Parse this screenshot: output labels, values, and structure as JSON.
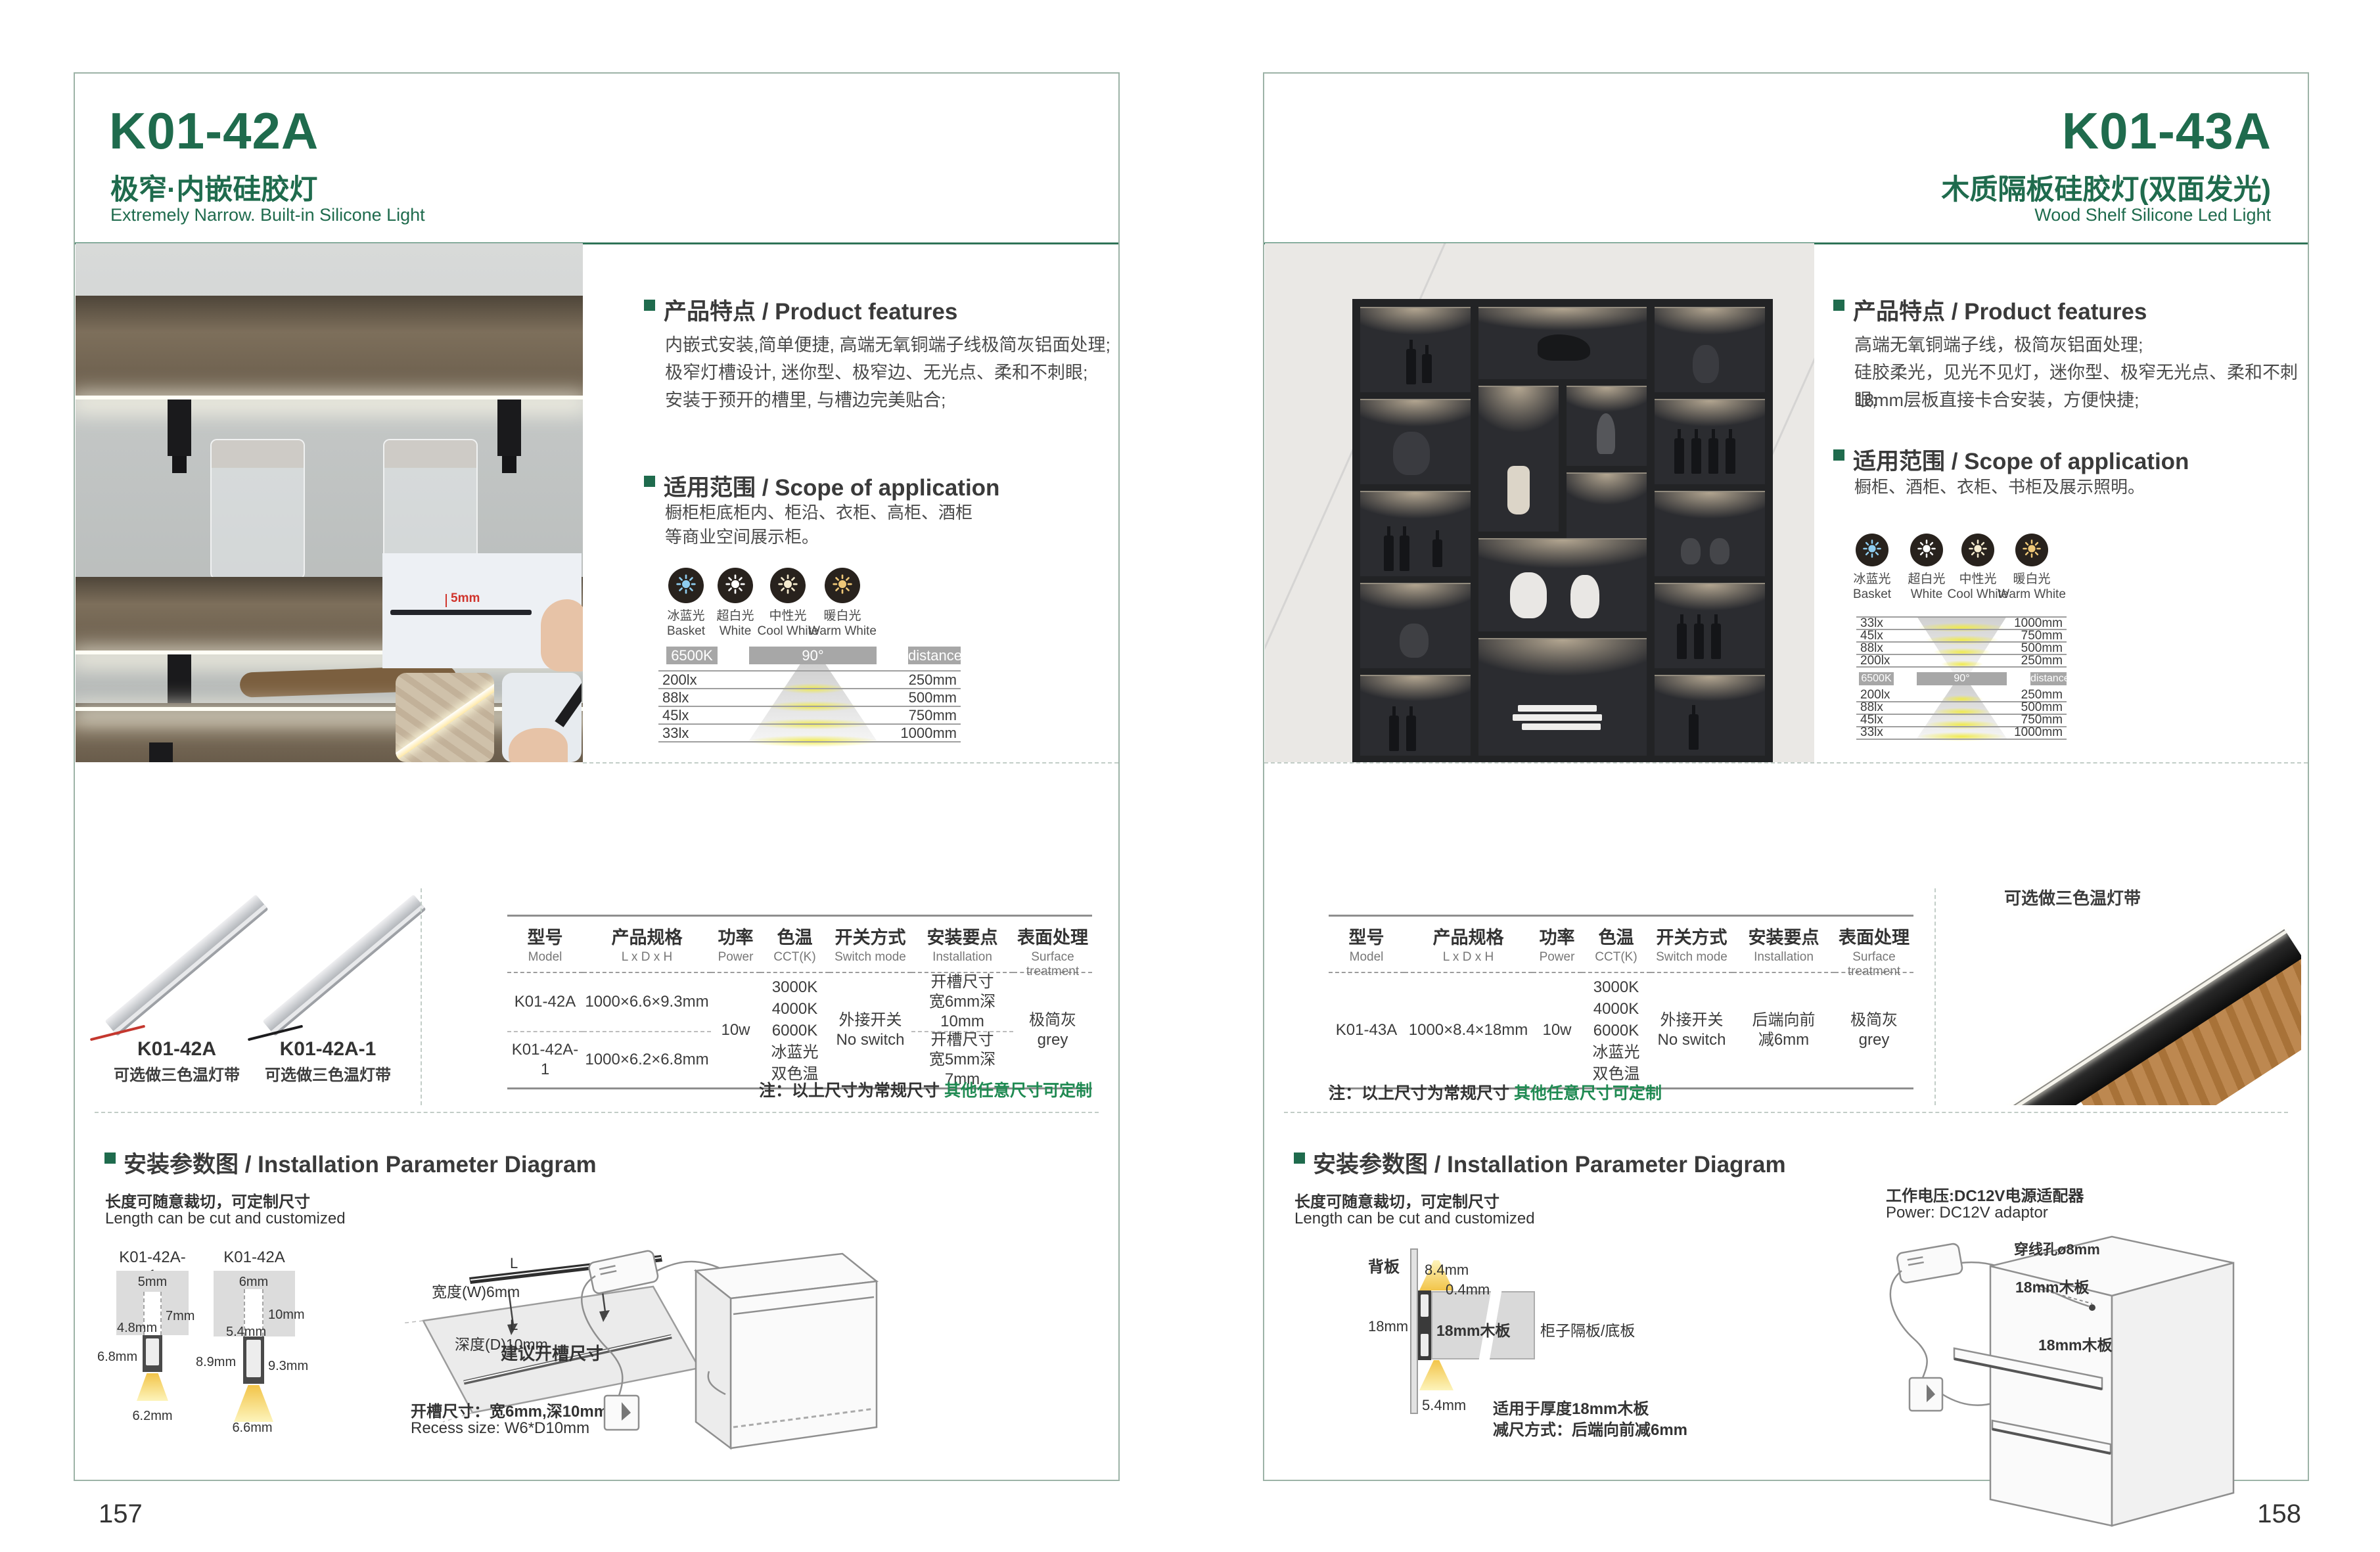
{
  "colors": {
    "green": "#1f6b4d",
    "note_green": "#1f8a52",
    "ice": "#8ecdf0",
    "white": "#ffffff",
    "neutral": "#f6ecd0",
    "warm": "#efc878",
    "bar_gray": "#a7a7a7"
  },
  "shared": {
    "features_title": "产品特点 / Product features",
    "scope_title": "适用范围 / Scope of application",
    "install_title": "安装参数图 / Installation Parameter Diagram",
    "cut_zh": "长度可随意裁切，可定制尺寸",
    "cut_en": "Length can be cut and customized",
    "note_black": "注：以上尺寸为常规尺寸 ",
    "note_green": "其他任意尺寸可定制",
    "chart": {
      "cct": "6500K",
      "angle": "90°",
      "dist": "distance"
    },
    "cct_icons": [
      {
        "zh": "冰蓝光",
        "en": "Basket"
      },
      {
        "zh": "超白光",
        "en": "White"
      },
      {
        "zh": "中性光",
        "en": "Cool White"
      },
      {
        "zh": "暖白光",
        "en": "Warm White"
      }
    ],
    "headers": [
      {
        "zh": "型号",
        "en": "Model"
      },
      {
        "zh": "产品规格",
        "en": "L x D x H"
      },
      {
        "zh": "功率",
        "en": "Power"
      },
      {
        "zh": "色温",
        "en": "CCT(K)"
      },
      {
        "zh": "开关方式",
        "en": "Switch mode"
      },
      {
        "zh": "安装要点",
        "en": "Installation"
      },
      {
        "zh": "表面处理",
        "en": "Surface treatment"
      }
    ]
  },
  "left": {
    "page_number": "157",
    "model": "K01-42A",
    "subtitle_zh": "极窄·内嵌硅胶灯",
    "subtitle_en": "Extremely Narrow. Built-in Silicone Light",
    "features": [
      "内嵌式安装,简单便捷, 高端无氧铜端子线极简灰铝面处理;",
      "极窄灯槽设计, 迷你型、极窄边、无光点、柔和不刺眼;",
      "安装于预开的槽里, 与槽边完美贴合;"
    ],
    "scope": "橱柜柜底柜内、柜沿、衣柜、高柜、酒柜\n等商业空间展示柜。",
    "inset_dim": "5mm",
    "chart_rows": [
      {
        "lux": "200lx",
        "mm": "250mm"
      },
      {
        "lux": "88lx",
        "mm": "500mm"
      },
      {
        "lux": "45lx",
        "mm": "750mm"
      },
      {
        "lux": "33lx",
        "mm": "1000mm"
      }
    ],
    "product1_name": "K01-42A",
    "product1_caption": "可选做三色温灯带",
    "product2_name": "K01-42A-1",
    "product2_caption": "可选做三色温灯带",
    "table": {
      "r1": {
        "model": "K01-42A",
        "size": "1000×6.6×9.3mm",
        "install": "开槽尺寸\n宽6mm深10mm"
      },
      "r2": {
        "model": "K01-42A-1",
        "size": "1000×6.2×6.8mm",
        "install": "开槽尺寸\n宽5mm深7mm"
      },
      "power": "10w",
      "cct": "3000K\n4000K\n6000K\n冰蓝光\n双色温",
      "switch": "外接开关\nNo switch",
      "surface": "极简灰\ngrey"
    },
    "diag1": {
      "label": "K01-42A-1",
      "top": "5mm",
      "depth": "7mm",
      "inner": "4.8mm",
      "height": "6.8mm",
      "bottom": "6.2mm"
    },
    "diag2": {
      "label": "K01-42A",
      "top": "6mm",
      "depth": "10mm",
      "inner": "5.4mm",
      "left": "8.9mm",
      "right": "9.3mm",
      "bottom": "6.6mm"
    },
    "board": {
      "w": "宽度(W)6mm",
      "d": "深度(D)10mm",
      "l1": "L",
      "l2": "L",
      "caption": "建议开槽尺寸"
    },
    "recess_zh": "开槽尺寸：宽6mm,深10mm",
    "recess_en": "Recess size: W6*D10mm"
  },
  "right": {
    "page_number": "158",
    "model": "K01-43A",
    "subtitle_zh": "木质隔板硅胶灯(双面发光)",
    "subtitle_en": "Wood Shelf Silicone Led Light",
    "features": [
      "高端无氧铜端子线，极简灰铝面处理;",
      "硅胶柔光，见光不见灯，迷你型、极窄无光点、柔和不刺眼;",
      "18mm层板直接卡合安装，方便快捷;"
    ],
    "scope": "橱柜、酒柜、衣柜、书柜及展示照明。",
    "chart_rows_top": [
      {
        "lux": "33lx",
        "mm": "1000mm"
      },
      {
        "lux": "45lx",
        "mm": "750mm"
      },
      {
        "lux": "88lx",
        "mm": "500mm"
      },
      {
        "lux": "200lx",
        "mm": "250mm"
      }
    ],
    "chart_rows_bottom": [
      {
        "lux": "200lx",
        "mm": "250mm"
      },
      {
        "lux": "88lx",
        "mm": "500mm"
      },
      {
        "lux": "45lx",
        "mm": "750mm"
      },
      {
        "lux": "33lx",
        "mm": "1000mm"
      }
    ],
    "product_caption": "可选做三色温灯带",
    "table": {
      "model": "K01-43A",
      "size": "1000×8.4×18mm",
      "power": "10w",
      "cct": "3000K\n4000K\n6000K\n冰蓝光\n双色温",
      "switch": "外接开关\nNo switch",
      "install": "后端向前\n减6mm",
      "surface": "极简灰\ngrey"
    },
    "cs": {
      "back": "背板",
      "d84": "8.4mm",
      "d04": "0.4mm",
      "d18": "18mm",
      "board": "18mm木板",
      "shelf": "柜子隔板/底板",
      "d54": "5.4mm",
      "fit1": "适用于厚度18mm木板",
      "fit2": "减尺方式：后端向前减6mm"
    },
    "power_zh": "工作电压:DC12V电源适配器",
    "power_en": "Power: DC12V adaptor",
    "hole": "穿线孔ø8mm",
    "wood1": "18mm木板",
    "wood2": "18mm木板"
  }
}
